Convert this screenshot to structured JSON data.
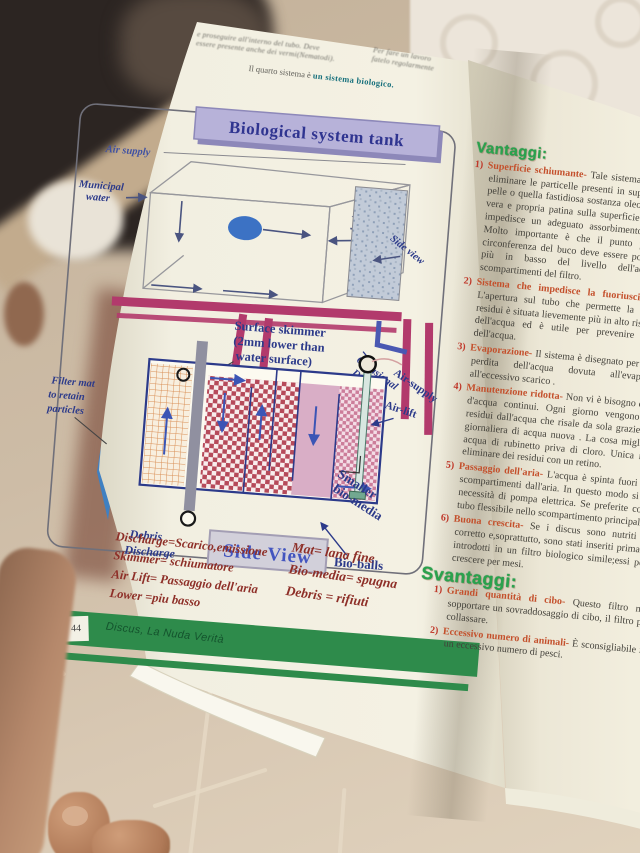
{
  "book": {
    "left_page": {
      "top_text": {
        "line1": "e proseguire all'interno del tubo. Deve",
        "line2": "essere presente anche dei vermi(Nematodi).",
        "right_line1": "Per fare un lavoro",
        "right_line2": "fatelo regolarmente",
        "intro_prefix": "Il quarto sistema è ",
        "intro_bold": "un sistema biologico."
      },
      "diagram": {
        "title": "Biological system tank",
        "labels": {
          "air_supply": "Air supply",
          "municipal_water": [
            "Municipal",
            "water"
          ],
          "side_view_arrow": "Side view",
          "occasional": [
            "Occasional",
            "Debris",
            "Discharge"
          ],
          "surface_skimmer": [
            "Surface skimmer",
            "(2mm lower than",
            "water surface)"
          ],
          "filter_mat": [
            "Filter mat",
            "to retain",
            "particles"
          ],
          "air_supply2": "Air-supply",
          "air_lift": "Air-lift",
          "smaller_bio": [
            "Smaller",
            "bio-media"
          ],
          "bio_balls": "Bio-balls",
          "debris_discharge": [
            "Debris",
            "Discharge"
          ],
          "side_view_box": "Side View"
        },
        "colors": {
          "banner": "#b7b2d9",
          "magenta": "#b23a6c",
          "navy": "#2c3a8a",
          "checker_red": "#b64a5a",
          "pink": "#d9aec6",
          "green_band": "#2e8b4b"
        }
      },
      "glossary": {
        "left": [
          "Discharge=Scarico,emissione",
          "Skimmer= schiumatore",
          "Air Lift= Passaggio dell'aria",
          "Lower =piu basso"
        ],
        "right": [
          "Mat= lana fine",
          "Bio-media= spugna",
          "Debris = rifiuti"
        ]
      },
      "footer": {
        "page_number": "44",
        "book_title": "Discus, La Nuda Verità"
      }
    },
    "right_page": {
      "vantaggi_heading": "Vantaggi:",
      "vantaggi": [
        {
          "num": "1)",
          "lead": "Superficie schiumante-",
          "body": "Tale sistema ha dei fori atti a eliminare le particelle presenti in superficie: eventuale pelle o quella fastidiosa sostanza oleosa che forma una vera e propria patina sulla superficie dell'acqua e che impedisce un adeguato assorbimento dell' ossigeno. Molto importante è che il punto più basso della circonferenza del buco deve essere posizionato 2 mm più in basso del livello dell'acqua o degli scompartimenti del filtro."
        },
        {
          "num": "2)",
          "lead": "Sistema che impedisce la fuoriuscita dell'acqua-",
          "body": "L'apertura sul tubo che permette la fuoriuscita dei residui è situata lievemente più in alto rispetto al livello dell'acqua ed è utile per prevenire la fuoriuscita dell'acqua."
        },
        {
          "num": "3)",
          "lead": "Evaporazione-",
          "body": "Il sistema è disegnato per ripristinare la perdita dell'acqua dovuta all'evaporazione o all'eccessivo scarico ."
        },
        {
          "num": "4)",
          "lead": "Manutenzione ridotta-",
          "body": "Non vi è bisogno di fare cambi d'acqua continui. Ogni giorno vengono eliminati i residui dall'acqua che risale da sola grazie all'aggiunta giornaliera di acqua nuova . La cosa migliore è usare acqua di rubinetto priva di cloro. Unica necessità di eliminare dei residui con un retino."
        },
        {
          "num": "5)",
          "lead": "Passaggio dell'aria-",
          "body": "L'acqua è spinta fuori dei diversi scompartimenti dall'aria. In questo modo si elimina la necessità di pompa elettrica. Se preferite collegate un tubo flessibile nello scompartimento principale."
        },
        {
          "num": "6)",
          "lead": "Buona crescita-",
          "body": "Se i discus sono nutriti in modo corretto e,soprattutto, sono stati inseriti prima di essere introdotti in un filtro biologico simile;essi potrebbero crescere per mesi."
        }
      ],
      "svantaggi_heading": "Svantaggi:",
      "svantaggi": [
        {
          "num": "1)",
          "lead": "Grandi quantità di cibo-",
          "body": "Questo filtro non può sopportare un sovraddosaggio di cibo, il filtro potrebbe collassare."
        },
        {
          "num": "2)",
          "lead": "Eccessivo numero di animali-",
          "body": "È sconsigliabile inserire un eccessivo numero di pesci."
        }
      ]
    }
  }
}
